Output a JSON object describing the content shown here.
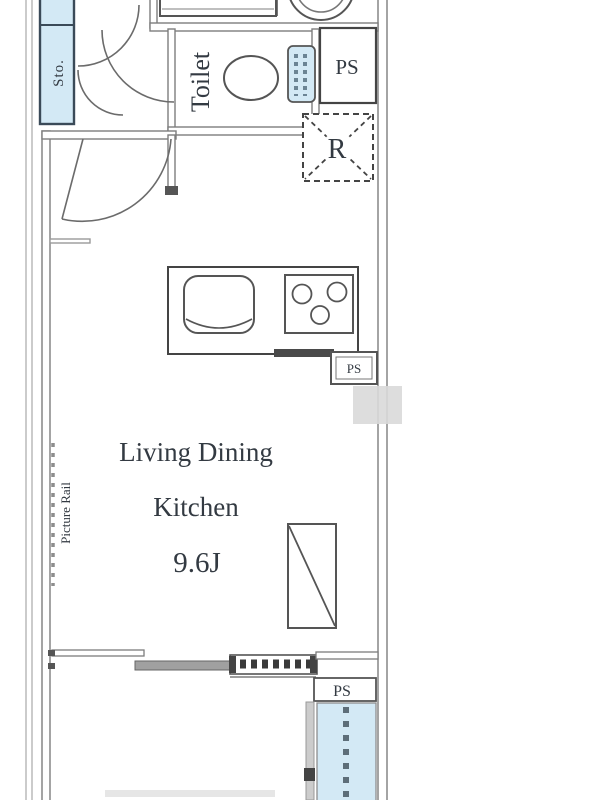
{
  "floorplan": {
    "labels": {
      "storage": "Sto.",
      "toilet": "Toilet",
      "pipe_space_top": "PS",
      "refrigerator": "R",
      "pipe_space_kitchen": "PS",
      "ldk_line1": "Living Dining",
      "ldk_line2": "Kitchen",
      "ldk_size": "9.6J",
      "picture_rail": "Picture Rail",
      "pipe_space_bottom": "PS"
    },
    "colors": {
      "fixture_blue": "#d3e9f5",
      "line_dark": "#4a4a4a",
      "wall_gray": "#7d7d7d",
      "text": "#333a42",
      "panel_gray": "#a0a0a0",
      "watermark_gray": "#d9d9d9"
    }
  }
}
